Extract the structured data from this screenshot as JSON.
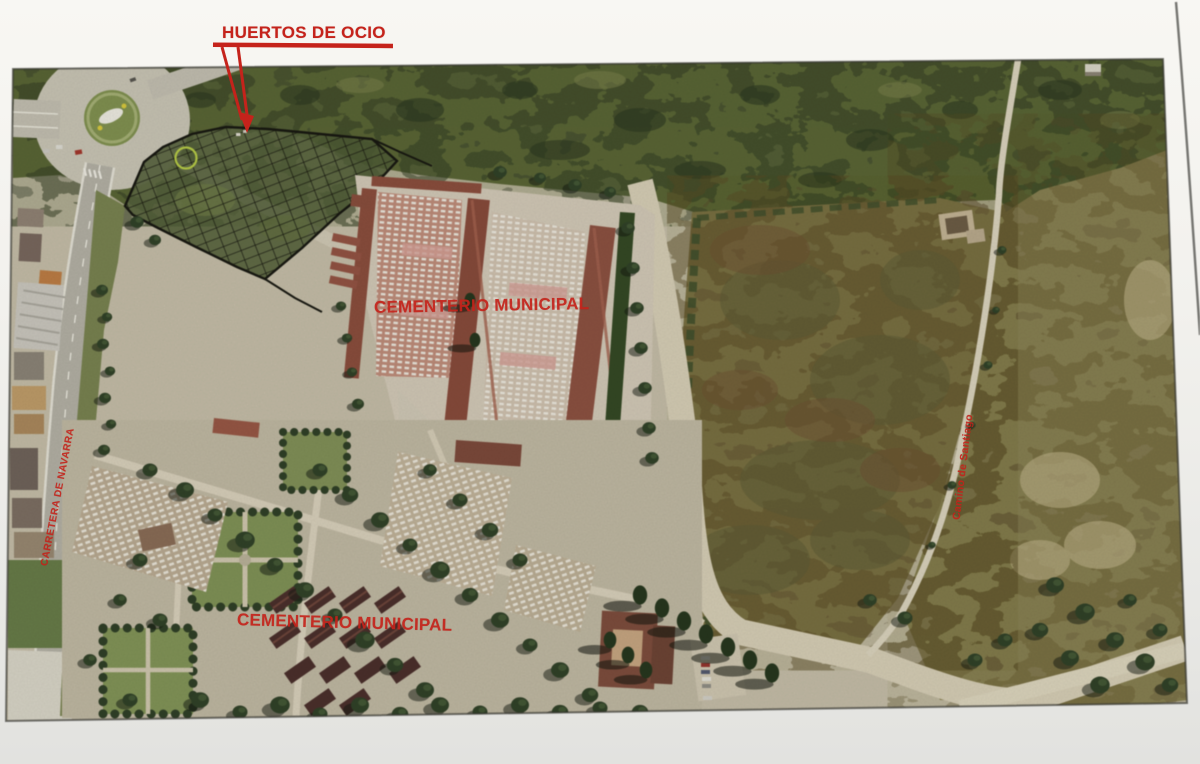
{
  "annotations": {
    "title": "HUERTOS DE OCIO",
    "upper_cemetery_label": "CEMENTERIO MUNICIPAL",
    "lower_cemetery_label": "CEMENTERIO MUNICIPAL",
    "left_road_label": "CARRETERA DE NAVARRA",
    "right_path_label": "Camino de Santiago",
    "label_color": "#c5231b"
  },
  "palette": {
    "paper": "#f2f1ed",
    "scrub_green": "#5d6836",
    "field_brown": "#7b7040",
    "cemetery_roof": "#8d4a38",
    "plot_outline": "#15150d",
    "dirt_road": "#d6cdb2"
  }
}
